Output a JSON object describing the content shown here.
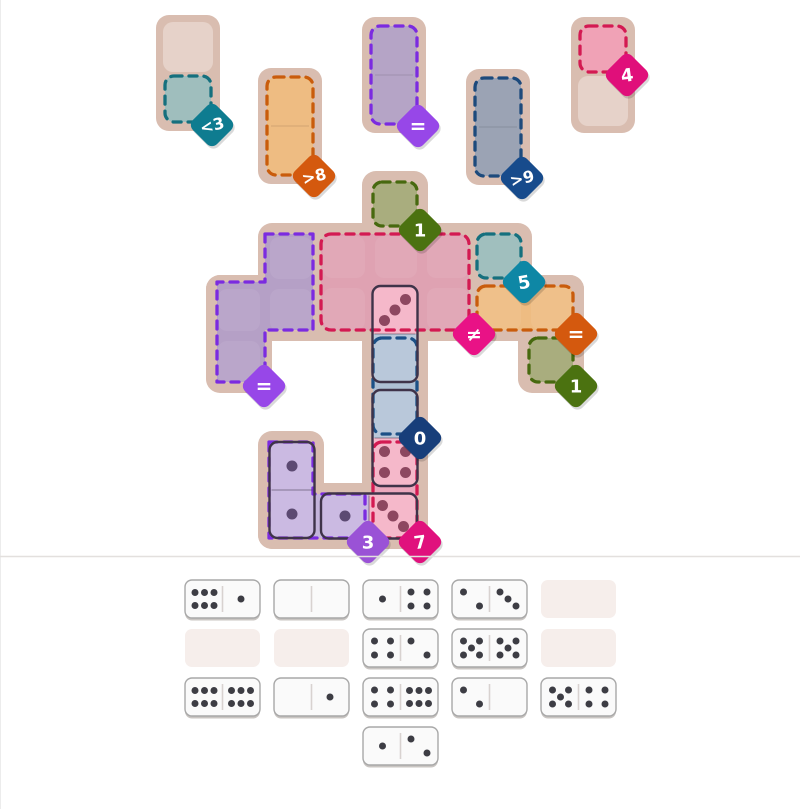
{
  "palette": {
    "board_tan": "#d9bdb0",
    "empty_cell": "#e6d2c9",
    "tray_empty_slot": "#f6eeeb",
    "tray_dot": "#3d3d44",
    "pink_half": "#f5b8ca",
    "blue_half": "#b9c8da",
    "purple_half": "#cbbae2",
    "pink_dot": "#8d4760",
    "purple_dot": "#5c4a72",
    "divider": "#e3e0de",
    "edge_line": "#ececec"
  },
  "mini_boards": [
    {
      "id": "teal",
      "region_fill": "#9fbebd",
      "region_dash": "#15707e",
      "badge": {
        "label": "<3",
        "color": "#0e7c90"
      }
    },
    {
      "id": "orange",
      "region_fill": "#eebc82",
      "region_dash": "#c95c0c",
      "badge": {
        "label": ">8",
        "color": "#d4590e"
      }
    },
    {
      "id": "purple",
      "region_fill": "#b5a4c6",
      "region_dash": "#7b2be0",
      "badge": {
        "label": "=",
        "color": "#9747e8"
      }
    },
    {
      "id": "slate",
      "region_fill": "#9ba3b4",
      "region_dash": "#1d4a7c",
      "badge": {
        "label": ">9",
        "color": "#174b8c"
      }
    },
    {
      "id": "pink",
      "region_fill": "#f0a2b6",
      "region_dash": "#d31a52",
      "badge": {
        "label": "4",
        "color": "#e00f7a"
      }
    }
  ],
  "board": {
    "regions": {
      "green_top": {
        "fill": "#a9ad7e",
        "dash": "#47690f",
        "badge": {
          "label": "1",
          "color": "#4b7210"
        }
      },
      "pink_main": {
        "fill": "#dfa2b2",
        "dash": "#d31a52",
        "badge": {
          "label": "≠",
          "color": "#e91286"
        }
      },
      "teal_single": {
        "fill": "#a0bfbe",
        "dash": "#15707e",
        "badge": {
          "label": "5",
          "color": "#0e87a5"
        }
      },
      "purple_left": {
        "fill": "#b5a0c6",
        "dash": "#7b2be0",
        "badge": {
          "label": "=",
          "color": "#9747e8"
        }
      },
      "orange_right": {
        "fill": "#eebc82",
        "dash": "#c95c0c",
        "badge": {
          "label": "=",
          "color": "#d4590e"
        }
      },
      "green_right": {
        "fill": "#a9ad7e",
        "dash": "#47690f",
        "badge": {
          "label": "1",
          "color": "#4b7210"
        }
      },
      "blue_center": {
        "fill": "#aebfd3",
        "dash": "#1c5086",
        "badge": {
          "label": "0",
          "color": "#173e7a"
        }
      },
      "pink_bottom": {
        "fill": "#eba8bd",
        "dash": "#d31a52",
        "badge": {
          "label": "7",
          "color": "#e0117d"
        }
      },
      "purple_bottom": {
        "fill": "#c4b4db",
        "dash": "#7b2be0",
        "badge": {
          "label": "3",
          "color": "#9a52d6"
        }
      }
    },
    "placed_dominoes": [
      {
        "id": "pink3-blue0",
        "a_pips": 3,
        "b_pips": 0
      },
      {
        "id": "blue0-pink4",
        "a_pips": 0,
        "b_pips": 4
      },
      {
        "id": "purple1-purple1",
        "a_pips": 1,
        "b_pips": 1
      },
      {
        "id": "purple1-pink3",
        "a_pips": 1,
        "b_pips": 3
      }
    ]
  },
  "tray": {
    "rows": [
      [
        {
          "pips": [
            6,
            1
          ]
        },
        {
          "pips": [
            0,
            0
          ]
        },
        {
          "pips": [
            1,
            4
          ]
        },
        {
          "pips": [
            2,
            3
          ]
        },
        null
      ],
      [
        null,
        null,
        {
          "pips": [
            4,
            2
          ]
        },
        {
          "pips": [
            5,
            5
          ]
        },
        null
      ],
      [
        {
          "pips": [
            6,
            6
          ]
        },
        {
          "pips": [
            0,
            1
          ]
        },
        {
          "pips": [
            4,
            6
          ]
        },
        {
          "pips": [
            2,
            0
          ]
        },
        {
          "pips": [
            5,
            4
          ]
        }
      ],
      [
        {
          "pips": [
            1,
            2
          ]
        }
      ]
    ]
  }
}
